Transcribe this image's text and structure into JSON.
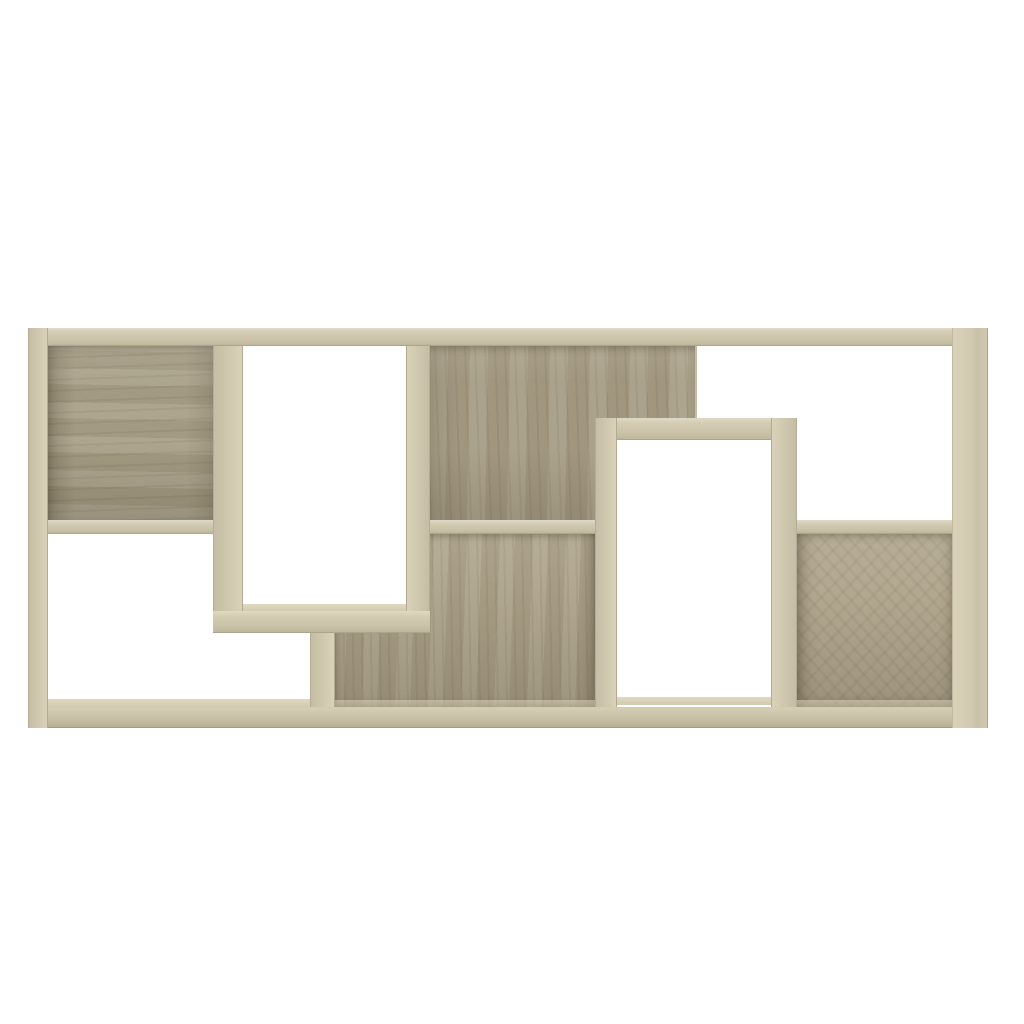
{
  "scene": {
    "type": "product-photo",
    "object": "geometric cube bookcase / wall shelf",
    "finish": "sonoma-oak",
    "description": "Geometric bookcase in Sonoma oak engineered wood on a plain white background: a wide rectangular frame with offset interlocking compartments, four compartments backed with oak panels and the others open through to the white background, including one tall open frame hanging from the top and one tall open frame rising from the base.",
    "background_color": "#ffffff"
  },
  "palette": {
    "board_face": "#cfc7ad",
    "board_highlight": "#ded6bd",
    "board_shadow": "#bfb79c",
    "panel_back": "#a9a088",
    "panel_back_dark": "#968c74",
    "floor_light": "#e0d8bf",
    "background": "#ffffff"
  },
  "parts": [
    {
      "id": "back-top-left",
      "label": "Top-left compartment back panel"
    },
    {
      "id": "back-top-middle",
      "label": "Top-middle compartment back panel"
    },
    {
      "id": "back-bottom-middle",
      "label": "Bottom-middle compartment back panel"
    },
    {
      "id": "back-bottom-right",
      "label": "Bottom-right compartment back panel"
    },
    {
      "id": "interior-frame-upper",
      "label": "Open interior of upper hanging frame compartment"
    },
    {
      "id": "interior-frame-lower",
      "label": "Open interior of lower standing frame compartment"
    },
    {
      "id": "floor-bottom-left",
      "label": "Bottom board top face in open bottom-left compartment"
    },
    {
      "id": "floor-frame-upper",
      "label": "Bottom board top face inside upper frame compartment"
    },
    {
      "id": "floor-frame-lower",
      "label": "Bottom board top face inside lower frame compartment"
    },
    {
      "id": "floor-bottom-middle",
      "label": "Bottom board top face in bottom-middle compartment"
    },
    {
      "id": "floor-bottom-right",
      "label": "Bottom board top face in bottom-right compartment"
    },
    {
      "id": "board-top",
      "label": "Top board"
    },
    {
      "id": "board-bottom",
      "label": "Bottom board"
    },
    {
      "id": "board-left",
      "label": "Left side board"
    },
    {
      "id": "board-right",
      "label": "Right side board"
    },
    {
      "id": "frame-upper-left",
      "label": "Upper frame left board"
    },
    {
      "id": "frame-upper-right",
      "label": "Upper frame right board"
    },
    {
      "id": "frame-upper-bottom",
      "label": "Upper frame bottom board"
    },
    {
      "id": "divider-under-frame",
      "label": "Short vertical divider below upper frame"
    },
    {
      "id": "frame-lower-top",
      "label": "Lower frame top board"
    },
    {
      "id": "frame-lower-left",
      "label": "Lower frame left board"
    },
    {
      "id": "frame-lower-right",
      "label": "Lower frame right board"
    },
    {
      "id": "shelf-left",
      "label": "Left shelf"
    },
    {
      "id": "shelf-middle",
      "label": "Middle shelf"
    },
    {
      "id": "shelf-right",
      "label": "Right shelf"
    }
  ]
}
